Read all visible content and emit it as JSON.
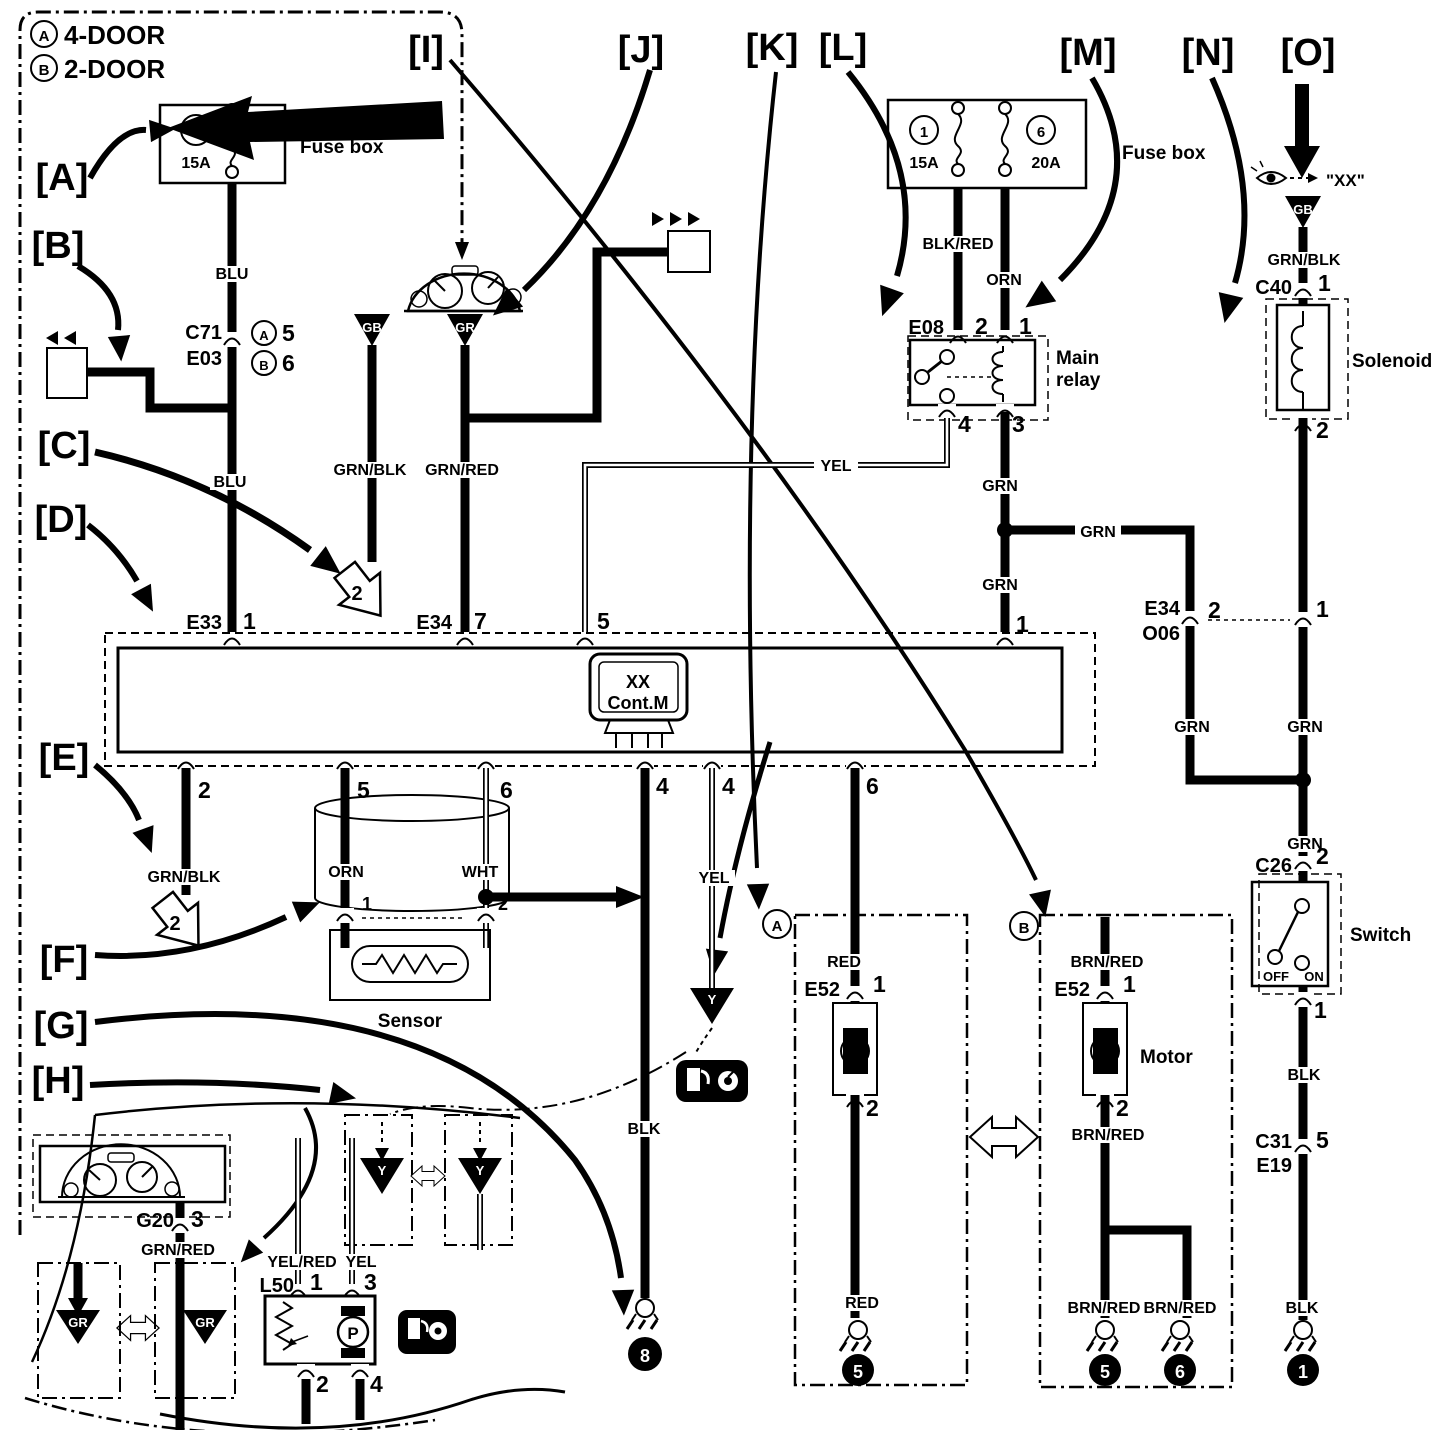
{
  "colors": {
    "ink": "#000000",
    "paper": "#ffffff",
    "shade": "#9a9a9a"
  },
  "legend": {
    "a_sym": "A",
    "a_text": "4-DOOR",
    "b_sym": "B",
    "b_text": "2-DOOR"
  },
  "callouts": {
    "a": "[A]",
    "b": "[B]",
    "c": "[C]",
    "d": "[D]",
    "e": "[E]",
    "f": "[F]",
    "g": "[G]",
    "h": "[H]",
    "i": "[I]",
    "j": "[J]",
    "k": "[K]",
    "l": "[L]",
    "m": "[M]",
    "n": "[N]",
    "o": "[O]"
  },
  "fusebox_left": {
    "label": "Fuse box",
    "fuse_num": "3",
    "fuse_amp": "15A"
  },
  "fusebox_right": {
    "label": "Fuse box",
    "fuse1_num": "1",
    "fuse1_amp": "15A",
    "fuse2_num": "6",
    "fuse2_amp": "20A"
  },
  "c71": {
    "name": "C71",
    "name2": "E03",
    "a_sym": "A",
    "a_pin": "5",
    "b_sym": "B",
    "b_pin": "6"
  },
  "relay": {
    "name": "E08",
    "pin_tl": "2",
    "pin_tr": "1",
    "pin_bl": "4",
    "pin_br": "3",
    "label1": "Main",
    "label2": "relay"
  },
  "module": {
    "e33": "E33",
    "e33_pin": "1",
    "e34": "E34",
    "e34_pin": "7",
    "pin5_top": "5",
    "pin1_top": "1",
    "icon1": "XX",
    "icon2": "Cont.M",
    "bp2": "2",
    "bp5": "5",
    "bp6a": "6",
    "bp4a": "4",
    "bp4b": "4",
    "bp6b": "6"
  },
  "e34o06": {
    "name1": "E34",
    "name2": "O06",
    "pin": "2",
    "link_pin": "1"
  },
  "solenoid": {
    "c40": "C40",
    "c40_pin": "1",
    "pin2": "2",
    "label": "Solenoid",
    "eye_target": "\"XX\"",
    "gb": "GB"
  },
  "switch": {
    "c26": "C26",
    "pin2": "2",
    "pin1": "1",
    "label": "Switch",
    "off": "OFF",
    "on": "ON",
    "c31": "C31",
    "e19": "E19",
    "c31_pin": "5"
  },
  "motor_a": {
    "variant": "A",
    "e52": "E52",
    "pin1": "1",
    "pin2": "2",
    "m": "M"
  },
  "motor_b": {
    "variant": "B",
    "e52": "E52",
    "pin1": "1",
    "pin2": "2",
    "m": "M",
    "label": "Motor"
  },
  "sensor": {
    "label": "Sensor",
    "pin1": "1",
    "pin2": "2"
  },
  "cluster": {
    "g20": "G20",
    "pin": "3"
  },
  "l50": {
    "name": "L50",
    "pin1": "1",
    "pin3": "3",
    "pin2": "2",
    "pin4": "4",
    "p": "P"
  },
  "wires": {
    "blu1": "BLU",
    "blu2": "BLU",
    "grnblk1": "GRN/BLK",
    "grnred1": "GRN/RED",
    "blkred": "BLK/RED",
    "orn1": "ORN",
    "yel1": "YEL",
    "grn1": "GRN",
    "grn2": "GRN",
    "grn3": "GRN",
    "grn4": "GRN",
    "grn5": "GRN",
    "grn6": "GRN",
    "grnblk2": "GRN/BLK",
    "orn2": "ORN",
    "wht": "WHT",
    "blk1": "BLK",
    "yel2": "YEL",
    "red1": "RED",
    "red2": "RED",
    "brnred1": "BRN/RED",
    "brnred2": "BRN/RED",
    "brnred3": "BRN/RED",
    "brnred4": "BRN/RED",
    "grnblk3": "GRN/BLK",
    "blk2": "BLK",
    "blk3": "BLK",
    "grnred2": "GRN/RED",
    "yelred": "YEL/RED",
    "yel3": "YEL"
  },
  "jumps": {
    "j1": "2",
    "j2": "2"
  },
  "grounds": {
    "g8": "8",
    "g5a": "5",
    "g5b": "5",
    "g6": "6",
    "g1": "1"
  },
  "tri": {
    "gb1": "GB",
    "gr1": "GR",
    "gb2": "GB",
    "gr2": "GR",
    "gr3": "GR",
    "y1": "Y",
    "y2": "Y",
    "y3": "Y"
  }
}
